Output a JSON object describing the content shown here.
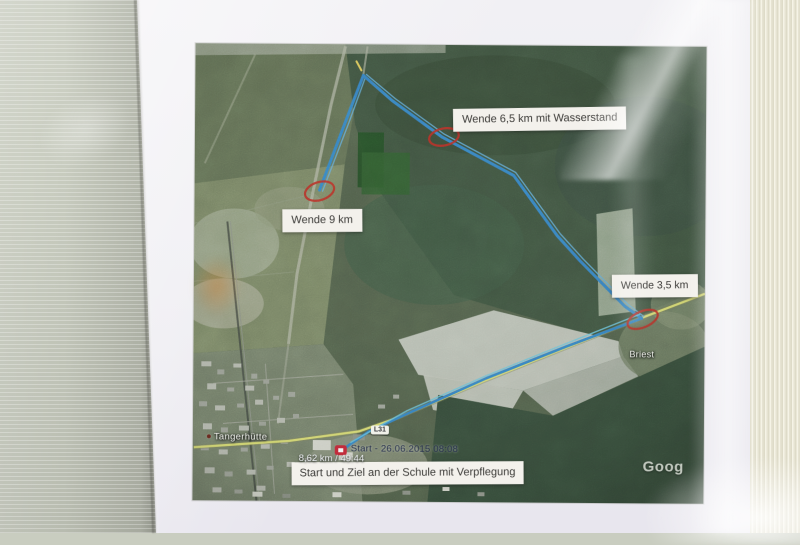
{
  "map": {
    "labels": {
      "wende_65": "Wende 6,5 km mit Wasserstand",
      "wende_9": "Wende 9 km",
      "wende_35": "Wende 3,5 km",
      "start_ziel": "Start und Ziel an der Schule mit Verpflegung"
    },
    "places": {
      "tangerhuette": "Tangerhütte",
      "briest": "Briest"
    },
    "road_badge": "L31",
    "gps": {
      "start_label": "Start - 26.06.2015 08:08",
      "stats": "8,62 km / 49:44"
    },
    "watermark": "Goog"
  },
  "colors": {
    "track_blue": "#2d7fc5",
    "track_cyan": "#63c3dc",
    "marker_red": "#c0281e",
    "road_yellow": "#d9dd67",
    "label_background": "#f3f1ec",
    "label_text": "#3b3a37"
  }
}
